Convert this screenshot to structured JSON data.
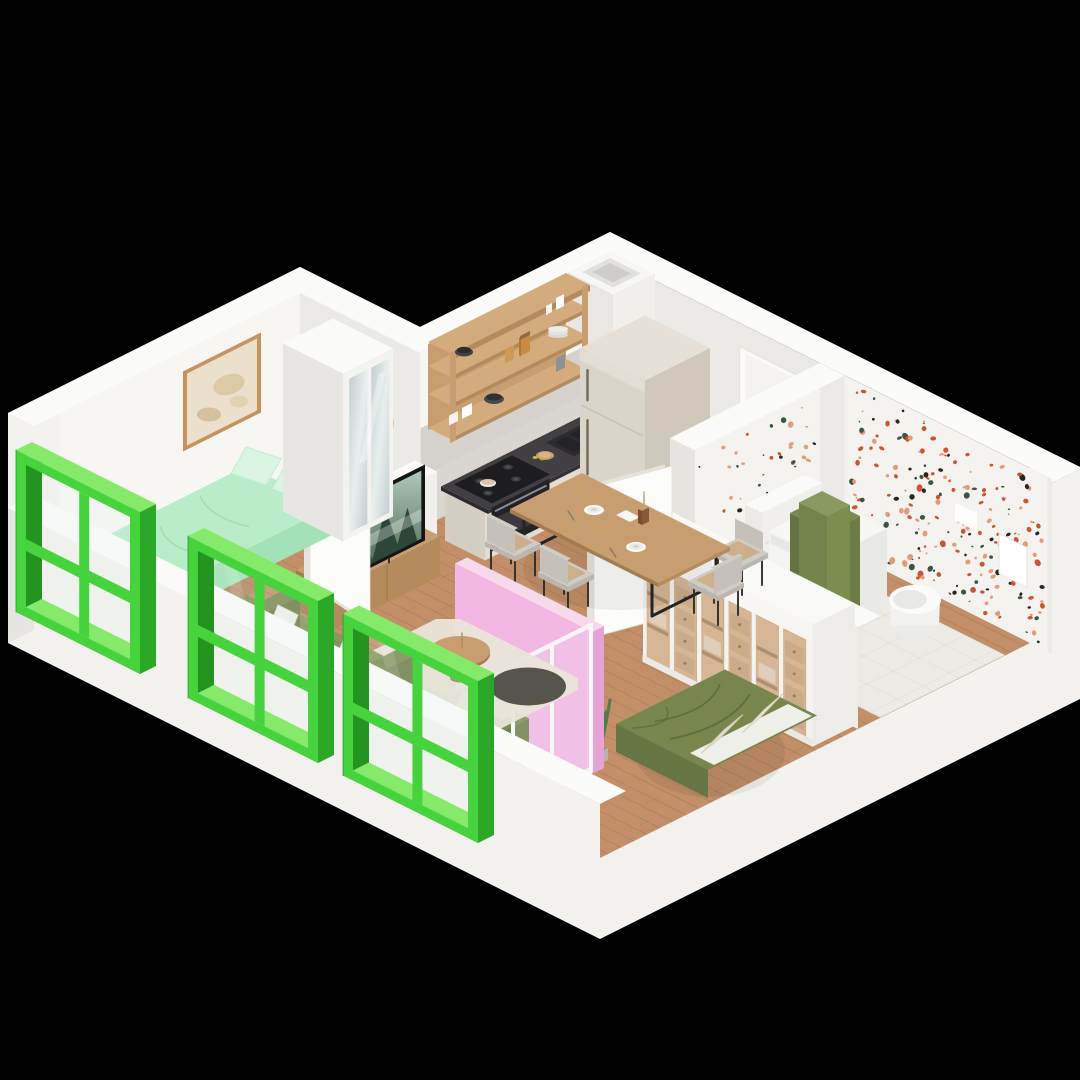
{
  "scene": {
    "type": "isometric-apartment-floorplan-render",
    "background": "#000000",
    "rooms": [
      {
        "id": "bedroom-1",
        "furniture": [
          "double-bed-mint",
          "mirrored-wardrobe",
          "framed-wall-art",
          "pampas-vase",
          "green-window"
        ]
      },
      {
        "id": "kitchen-dining",
        "furniture": [
          "open-wood-shelving",
          "dishes",
          "counter-with-sink",
          "cooktop-and-oven",
          "fridge",
          "vent-shaft",
          "entrance-door",
          "dining-table",
          "chairs",
          "tableware"
        ]
      },
      {
        "id": "living-area",
        "furniture": [
          "tv-console",
          "tv",
          "green-sofa",
          "coffee-table",
          "area-rug",
          "open-door-leaf",
          "half-wall-ledge"
        ]
      },
      {
        "id": "bedroom-2",
        "furniture": [
          "double-bed-olive",
          "sliding-glass-wardrobe",
          "floor-plant",
          "glass-partition",
          "open-door-leaf"
        ]
      },
      {
        "id": "bathroom",
        "furniture": [
          "terrazzo-walls",
          "washing-machine",
          "towels",
          "wall-hung-toilet",
          "storage-cabinet",
          "wall-niche",
          "flush-plate"
        ]
      },
      {
        "id": "loggia",
        "furniture": [
          "pink-walls",
          "green-armchair",
          "cushions",
          "green-window"
        ]
      }
    ],
    "windows": [
      "bedroom-1-window",
      "living-window",
      "loggia-window"
    ],
    "palette": {
      "bg": "#000000",
      "wall_top": "#fbfbf9",
      "wall_light": "#f3f2ef",
      "wall_pu": "#f7f6f2",
      "wall_pv": "#eceae6",
      "wall_shade": "#e7e5e1",
      "floor_wood": "#c28f68",
      "floor_line": "#a1764f",
      "tile": "#edebe5",
      "screed": "#dcddd7",
      "wood": "#c89d70",
      "wood_side": "#b58a5c",
      "wood_dark": "#a57c50",
      "counter_top": "#413f42",
      "counter_side": "#333135",
      "appliance_black": "#1d1d1f",
      "cabinet": "#e2dcd2",
      "cabinet_side": "#d5cec2",
      "beige_top": "#e6e0d6",
      "beige_front": "#dbd4c9",
      "beige_side": "#cfc8bb",
      "green_face": "#46d33d",
      "green_top": "#85ea69",
      "green_dark": "#2ca828",
      "green_deep": "#23941f",
      "glass": "rgba(226,240,236,0.16)",
      "mint": "#b9edc9",
      "mint_side": "#a3e2b6",
      "mint_pillow": "#daf5e1",
      "olive": "#78864e",
      "olive_side": "#687645",
      "olive_dark": "#5d6b3c",
      "sheet": "#eef0e9",
      "pillow_beige": "#e7e1d0",
      "pink": "#f3b7e5",
      "pink_top": "#f7d9ee",
      "pink_side": "#e6a3d6",
      "chair": "#cfccc5",
      "chair_side": "#bbb7af",
      "chair_back": "#c5c1ba",
      "chair_cushion": "#cda983",
      "rug": "#e9e5d9",
      "rug_dark": "#56554d",
      "terr_base": "#f5f3ef",
      "terr_o": "#cd5430",
      "terr_p": "#e29d78",
      "terr_g": "#3a5743",
      "terr_k": "#26251f",
      "mirror1": "#c3cdce",
      "mirror2": "#e8efef",
      "tv_dark": "#151515",
      "tv_sky": "#b0c8b8",
      "tv_ground": "#41624e",
      "tree": "#2c473a",
      "white": "#fafaf9",
      "washer": "#f4f4f1",
      "steel": "#a9adb0",
      "plant": "#567a4b",
      "plant_dark": "#3f5c39",
      "pampas": "#c9a577",
      "door_leaf": "#fcfcfa",
      "door_edge": "#e6e3dd",
      "shadow": "rgba(0,0,0,0.06)"
    }
  }
}
